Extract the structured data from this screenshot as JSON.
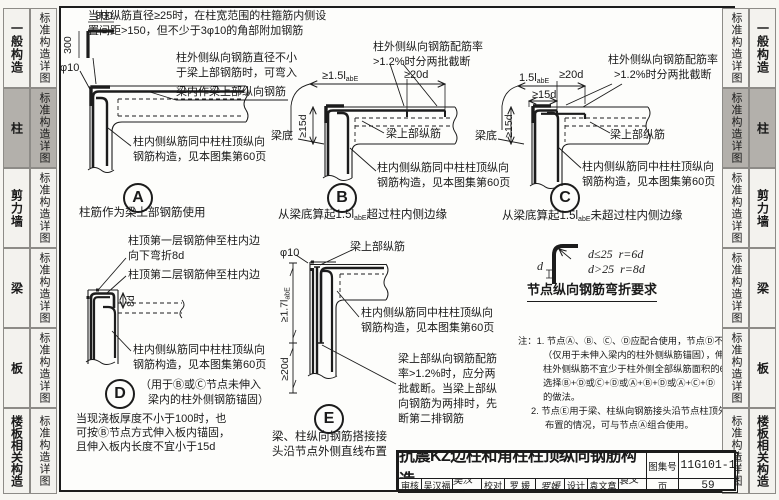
{
  "sidebar": {
    "common_label": "标准构造详图",
    "sections": [
      "一般构造",
      "柱",
      "剪力墙",
      "梁",
      "板",
      "楼板相关构造"
    ],
    "active_section": "柱",
    "active_bg": "#b3b0ab"
  },
  "top_note": {
    "line1": "当柱纵筋直径≥25时，在柱宽范围的柱箍筋内侧设",
    "line2": "置间距>150，但不少于3φ10的角部附加钢筋"
  },
  "common": {
    "inner_note1": "柱内侧纵筋同中柱柱顶纵向",
    "inner_note2": "钢筋构造，见本图集第60页",
    "beam_top_label": "梁上部纵筋",
    "beam_bottom_label": "梁底"
  },
  "detail_a": {
    "letter": "A",
    "dim_h": "300",
    "dim_v": "300",
    "phi": "φ10",
    "ann_outer1": "柱外侧纵向钢筋直径不小",
    "ann_outer2": "于梁上部钢筋时，可弯入",
    "ann_outer3": "梁内作梁上部纵向钢筋",
    "caption": "柱筋作为梁上部钢筋使用"
  },
  "detail_b": {
    "letter": "B",
    "dim1_pre": "≥1.5l",
    "dim1_sub": "abE",
    "dim2": "≥20d",
    "dim_v": "≥15d",
    "ann_cut1": "柱外侧纵向钢筋配筋率",
    "ann_cut2": ">1.2%时分两批截断",
    "caption_pre": "从梁底算起1.5l",
    "caption_sub": "abE",
    "caption_post": "超过柱内侧边缘"
  },
  "detail_c": {
    "letter": "C",
    "dim1_pre": "1.5l",
    "dim1_sub": "abE",
    "dim2": "≥20d",
    "dim_h15": "≥15d",
    "dim_v": "≥15d",
    "ann_cut1": "柱外侧纵向钢筋配筋率",
    "ann_cut2": ">1.2%时分两批截断",
    "caption_pre": "从梁底算起1.5l",
    "caption_sub": "abE",
    "caption_post": "未超过柱内侧边缘"
  },
  "detail_d": {
    "letter": "D",
    "dim_8d": "8d",
    "ann1a": "柱顶第一层钢筋伸至柱内边",
    "ann1b": "向下弯折8d",
    "ann2": "柱顶第二层钢筋伸至柱内边",
    "usage1": "（用于Ⓑ或Ⓒ节点未伸入",
    "usage2": "梁内的柱外侧钢筋锚固）",
    "note1": "当现浇板厚度不小于100时，也",
    "note2": "可按Ⓑ节点方式伸入板内锚固，",
    "note3": "且伸入板内长度不宜小于15d"
  },
  "detail_e": {
    "letter": "E",
    "phi": "φ10",
    "dim1_pre": "≥1.7l",
    "dim1_sub": "abE",
    "dim2": "≥20d",
    "ann_cut1": "梁上部纵向钢筋配筋",
    "ann_cut2": "率>1.2%时，应分两",
    "ann_cut3": "批截断。当梁上部纵",
    "ann_cut4": "向钢筋为两排时，先",
    "ann_cut5": "断第二排钢筋",
    "caption1": "梁、柱纵向钢筋搭接接",
    "caption2": "头沿节点外侧直线布置"
  },
  "bend_req": {
    "d_label": "d",
    "row1_cond": "d≤25",
    "row1_val": "r=6d",
    "row2_cond": "d>25",
    "row2_val": "r=8d",
    "title": "节点纵向钢筋弯折要求"
  },
  "notes": {
    "lines": [
      "注：1. 节点Ⓐ、Ⓑ、Ⓒ、Ⓓ应配合使用，节点Ⓓ不应单独使用",
      "（仅用于未伸入梁内的柱外侧纵筋锚固），伸入梁内的",
      "柱外侧纵筋不宜少于柱外侧全部纵筋面积的65%。可",
      "选择Ⓑ+Ⓓ或Ⓒ+Ⓓ或Ⓐ+Ⓑ+Ⓓ或Ⓐ+Ⓒ+Ⓓ",
      "的做法。",
      "2. 节点Ⓔ用于梁、柱纵向钢筋接头沿节点柱顶外侧直线",
      "布置的情况，可与节点Ⓐ组合使用。"
    ]
  },
  "title_block": {
    "title": "抗震KZ边柱和角柱柱顶纵向钢筋构造",
    "atlas_label": "图集号",
    "atlas_no": "11G101-1",
    "page_label": "页",
    "page_no": "59",
    "review_label": "审核",
    "review_name": "吴汉福",
    "review_sig": "吴汉福",
    "proof_label": "校对",
    "proof_name": "罗 媛",
    "proof_sig": "罗媛",
    "design_label": "设计",
    "design_name": "袁文章",
    "design_sig": "袁文章"
  }
}
